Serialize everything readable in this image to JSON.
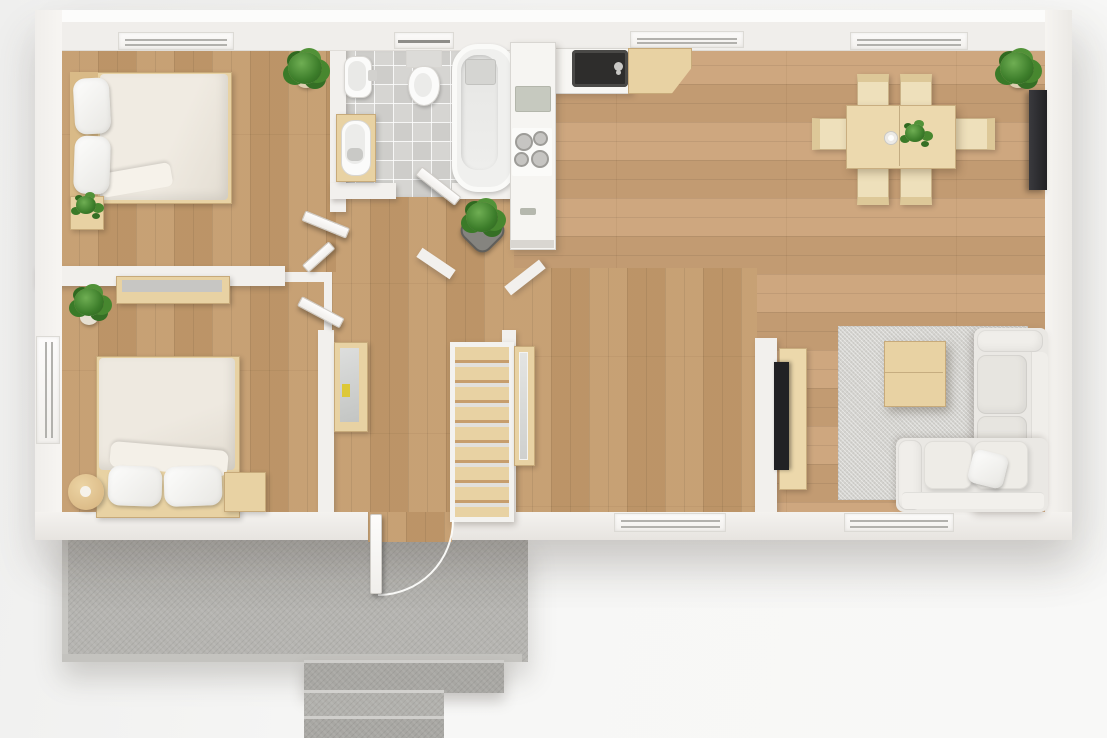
{
  "scene": {
    "kind": "3d-top-down-floor-plan-render",
    "canvas": {
      "width": 1107,
      "height": 738
    },
    "visible_text": []
  },
  "palette": {
    "background": "#f6f6f5",
    "wall": "#f2f0ed",
    "wall_light": "#fbfaf8",
    "wall_shade": "#ddd9d4",
    "wood": "#c49b6c",
    "wood_light": "#cba277",
    "tile": "#d6d5d2",
    "concrete": "#b5b4b0",
    "concrete_dark": "#a8a7a3",
    "rug": "#d4d3cf",
    "sofa": "#eae8e4",
    "sofa_light": "#f0eeea",
    "textile": "#ece7de",
    "furniture_wood": "#e8d2a3",
    "furniture_wood_dark": "#d9ba87",
    "fixture": "#fbfbfa",
    "plant_green": "#3f7e2d",
    "pot_tan": "#d9c9ab",
    "pot_gray": "#85847f",
    "tv_black": "#212124",
    "sink_black": "#2e2d2c",
    "glass_gray": "#b2b1ad"
  },
  "rooms": [
    {
      "id": "bedroom-top-left",
      "name": "bedroom top-left",
      "floor": "wood-planks-vertical",
      "furniture": [
        "double-bed-with-headboard",
        "pillow",
        "pillow",
        "duvet",
        "nightstand",
        "potted-plant-corner",
        "potted-plant-on-nightstand"
      ],
      "windows": 1,
      "door_leaves": 2
    },
    {
      "id": "bathroom",
      "name": "bathroom",
      "floor": "gray-tiles",
      "furniture": [
        "toilet-with-tank",
        "wall-washbasin",
        "wood-vanity-basin",
        "bathtub"
      ],
      "windows": 1,
      "door_leaves": 1
    },
    {
      "id": "kitchen",
      "name": "kitchen",
      "floor": "wood-planks-horizontal",
      "furniture": [
        "counter-column",
        "cutting-board",
        "cooktop-4-burners",
        "drawer-handle",
        "dark-sink-with-faucet",
        "wood-counter-angled"
      ],
      "windows": 1
    },
    {
      "id": "dining-area",
      "name": "dining area",
      "floor": "wood-planks-horizontal",
      "furniture": [
        "dining-table",
        "chair",
        "chair",
        "chair",
        "chair",
        "chair",
        "chair",
        "table-plant",
        "white-cup",
        "corner-potted-plant",
        "wall-tv"
      ],
      "windows": 1
    },
    {
      "id": "living-area",
      "name": "living area",
      "floor": "wood-planks-horizontal",
      "furniture": [
        "area-rug",
        "coffee-table",
        "corner-sofa",
        "throw-pillow",
        "tv-on-wood-panel",
        "divider-wall"
      ],
      "windows": 1
    },
    {
      "id": "hallway",
      "name": "hallway",
      "floor": "wood-planks-vertical",
      "furniture": [
        "staircase-8-treads",
        "mirror-cabinet",
        "tall-wardrobe-with-mirror",
        "floor-plant-gray-pot"
      ],
      "windows": 0
    },
    {
      "id": "bedroom-bottom-left",
      "name": "bedroom bottom-left",
      "floor": "wood-planks-vertical",
      "furniture": [
        "double-bed-with-footboard",
        "pillow",
        "pillow",
        "duvet",
        "round-stool",
        "nightstand",
        "wall-shelf",
        "potted-plant"
      ],
      "windows": 1,
      "door_leaves": 1
    },
    {
      "id": "exterior",
      "name": "patio and entrance",
      "floor": "concrete",
      "furniture": [
        "concrete-patio",
        "entry-steps-3",
        "front-door-with-swing-arc"
      ]
    }
  ],
  "totals": {
    "windows": 7,
    "door_leaves": 5,
    "plants": 6,
    "stair_treads": 8,
    "dining_chairs": 6,
    "sofa_sections": 2
  }
}
